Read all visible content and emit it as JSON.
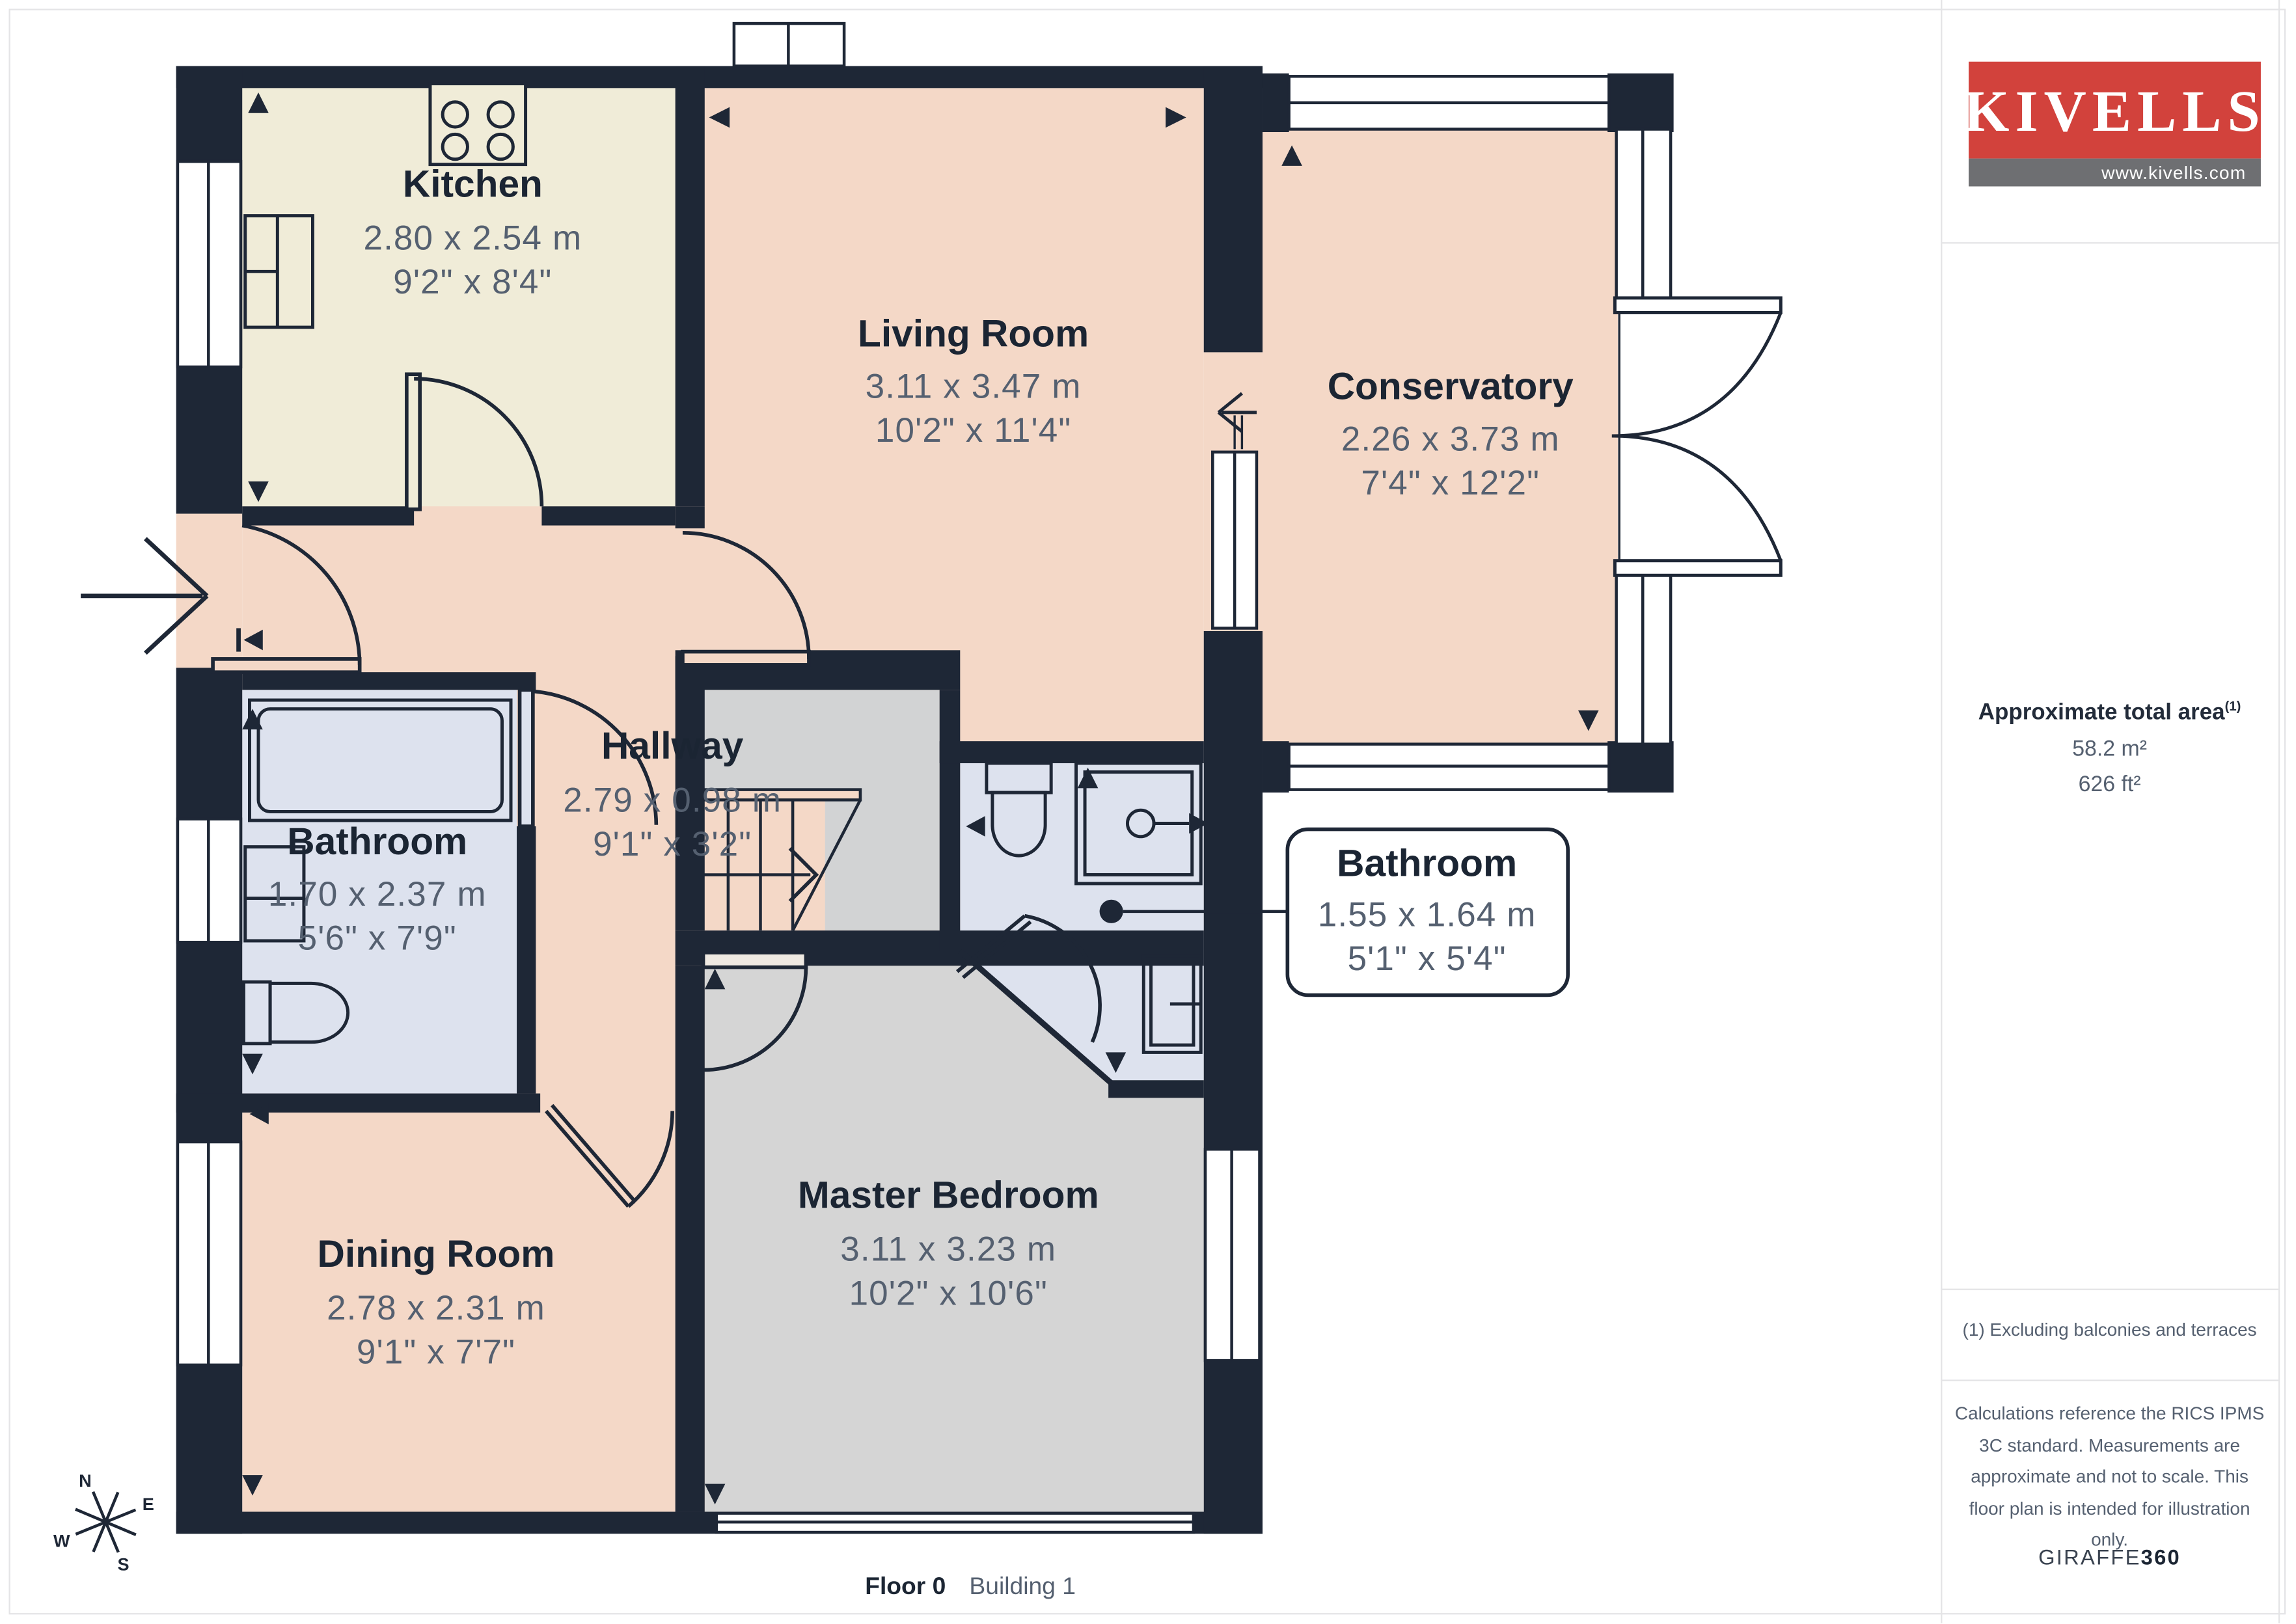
{
  "rooms": [
    {
      "name": "Kitchen",
      "metric": "2.80 x 2.54 m",
      "imperial": "9'2\" x 8'4\""
    },
    {
      "name": "Living Room",
      "metric": "3.11 x 3.47 m",
      "imperial": "10'2\" x 11'4\""
    },
    {
      "name": "Conservatory",
      "metric": "2.26 x 3.73 m",
      "imperial": "7'4\" x 12'2\""
    },
    {
      "name": "Hallway",
      "metric": "2.79 x 0.98 m",
      "imperial": "9'1\" x 3'2\""
    },
    {
      "name": "Bathroom",
      "metric": "1.70 x 2.37 m",
      "imperial": "5'6\" x 7'9\""
    },
    {
      "name": "Bathroom",
      "metric": "1.55 x 1.64 m",
      "imperial": "5'1\" x 5'4\""
    },
    {
      "name": "Dining Room",
      "metric": "2.78 x 2.31 m",
      "imperial": "9'1\" x 7'7\""
    },
    {
      "name": "Master Bedroom",
      "metric": "3.11 x 3.23 m",
      "imperial": "10'2\" x 10'6\""
    }
  ],
  "compass": {
    "n": "N",
    "e": "E",
    "s": "S",
    "w": "W"
  },
  "caption": {
    "floor": "Floor 0",
    "building": "Building 1"
  },
  "sidebar": {
    "logo": {
      "brand": "KIVELLS",
      "website": "www.kivells.com"
    },
    "area": {
      "title": "Approximate total area",
      "superscript": "(1)",
      "metric": "58.2 m²",
      "imperial": "626 ft²"
    },
    "footnote": "(1) Excluding balconies and terraces",
    "disclaimer_lines": [
      "Calculations reference the RICS IPMS",
      "3C standard. Measurements are",
      "approximate and not to scale. This",
      "floor plan is intended for illustration",
      "only."
    ],
    "brand_footer": {
      "name": "GIRAFFE",
      "suffix": "360"
    }
  },
  "colors": {
    "wall": "#1e2736",
    "room_pink": "#f4d8c7",
    "kitchen_cream": "#f0ecd8",
    "bathroom_lavender": "#dde2ee",
    "bedroom_grey": "#d5d5d5",
    "label_dark": "#1b2533",
    "label_grey": "#556070",
    "logo_red": "#d2423c",
    "logo_grey": "#6e6f72"
  }
}
